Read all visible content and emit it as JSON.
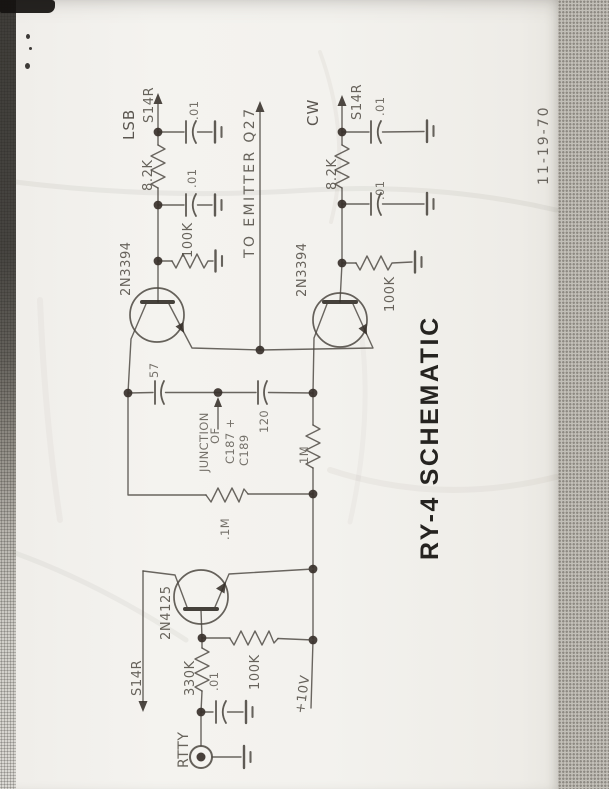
{
  "document": {
    "title": "RY-4 SCHEMATIC",
    "date": "11-19-70"
  },
  "lsb_channel": {
    "name": "LSB",
    "output_label": "S14R",
    "series_resistor": "8.2K",
    "cap_top": ".01",
    "cap_mid": ".01",
    "base_resistor": "100K",
    "transistor": "2N3394"
  },
  "cw_channel": {
    "name": "CW",
    "output_label": "S14R",
    "series_resistor": "8.2K",
    "cap_top": ".01",
    "cap_mid": ".01",
    "base_resistor": "100K",
    "transistor": "2N3394"
  },
  "coupling": {
    "to_emitter_label": "TO EMITTER Q27",
    "cap_left": "57",
    "cap_right": "120",
    "junction_word1": "JUNCTION",
    "junction_word2": "OF",
    "junction_ref1": "C187 +",
    "junction_ref2": "C189",
    "resistor_vertical": "1M",
    "resistor_horizontal": ".1M"
  },
  "keyer": {
    "transistor": "2N4125",
    "base_resistor": "330K",
    "supply_resistor": "100K",
    "bypass_cap": ".01",
    "output_label": "S14R",
    "input_jack": "RTTY",
    "supply": "+10V"
  },
  "colors": {
    "ink": "#4b463f",
    "title_ink": "#1b1916",
    "paper": "#f3f2ee",
    "scanner_band": "#c2bfb8"
  }
}
